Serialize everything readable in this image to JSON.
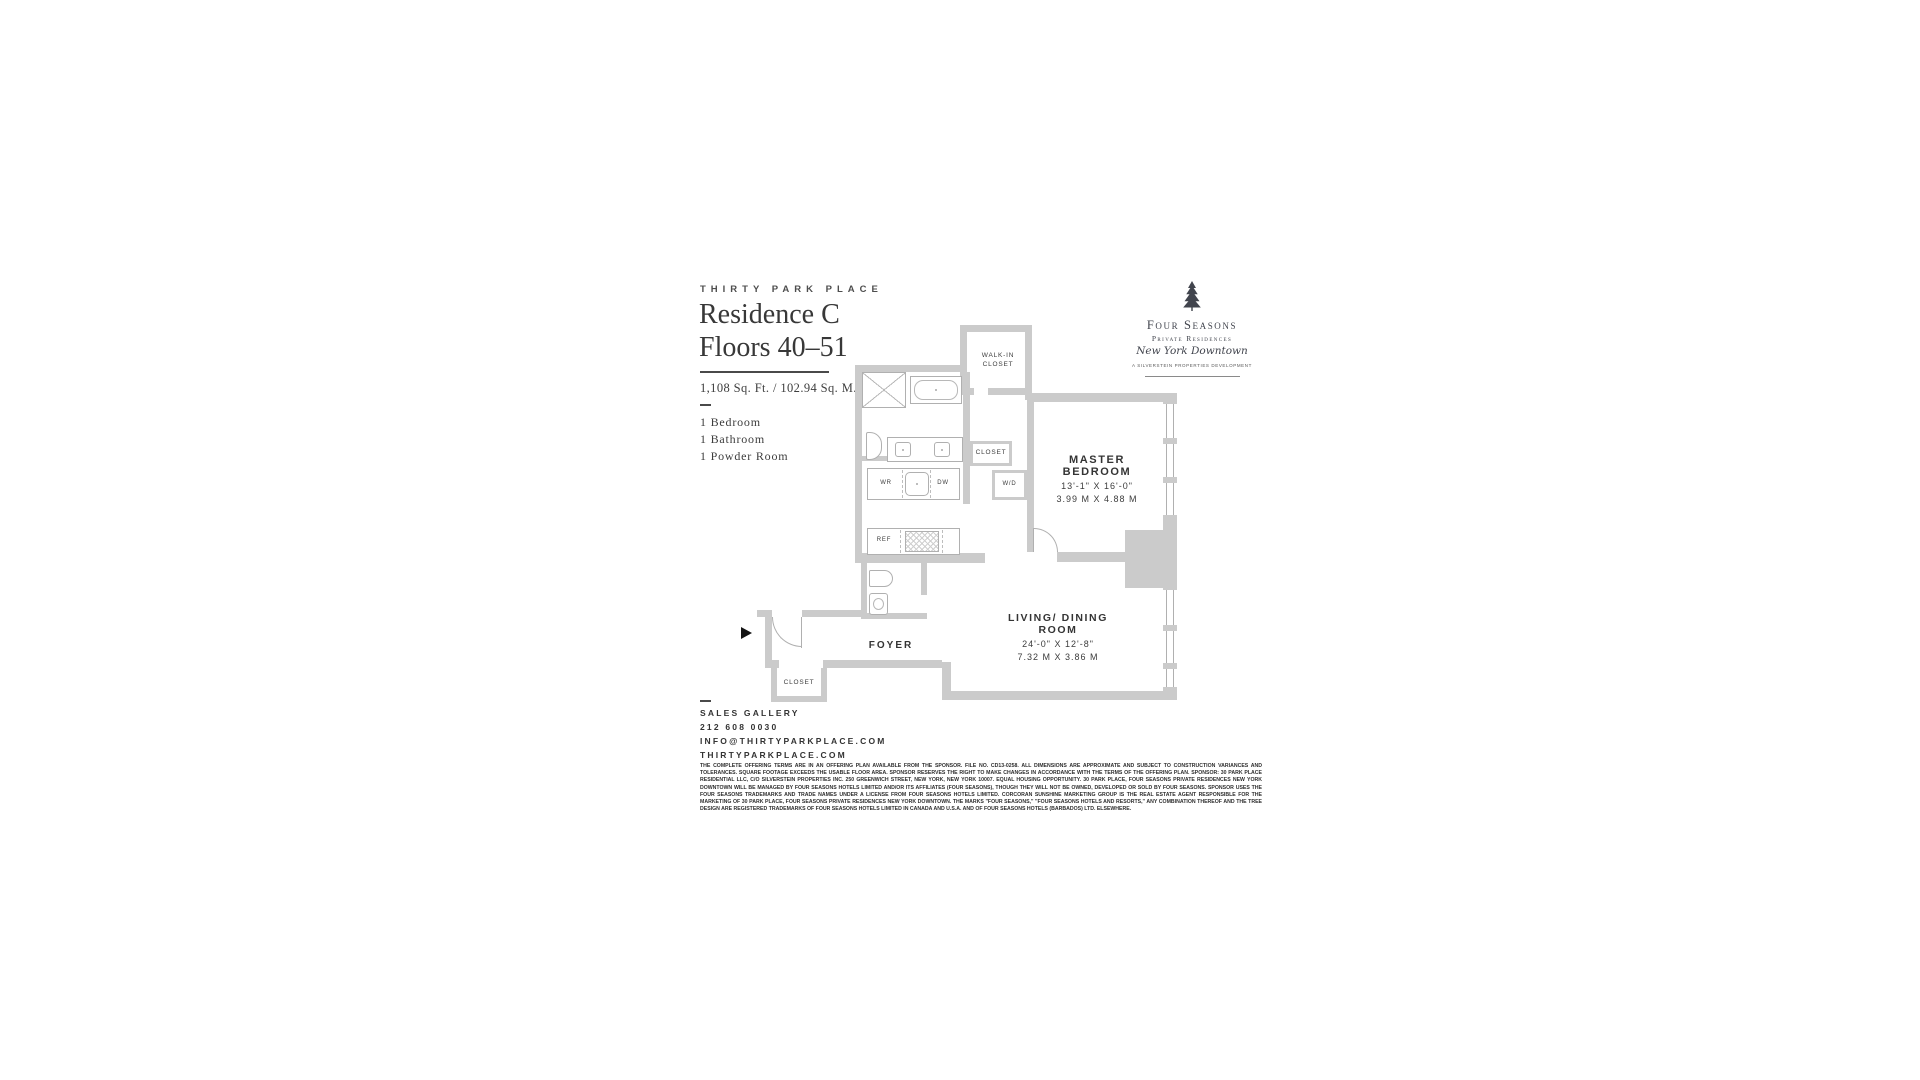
{
  "header": {
    "eyebrow": "THIRTY PARK PLACE",
    "title_line1": "Residence C",
    "title_line2": "Floors 40–51",
    "area": "1,108 Sq. Ft. / 102.94 Sq. M.",
    "features": [
      "1 Bedroom",
      "1 Bathroom",
      "1 Powder Room"
    ]
  },
  "logo": {
    "name": "Four Seasons",
    "subtitle": "Private Residences",
    "script": "New York Downtown",
    "tagline": "A SILVERSTEIN PROPERTIES DEVELOPMENT"
  },
  "plan": {
    "walk_in_closet": "WALK-IN CLOSET",
    "master_closet": "CLOSET",
    "washer_dryer": "W/D",
    "wine_ref": "WR",
    "dishwasher": "DW",
    "refrigerator": "REF",
    "master_bedroom": {
      "name": "MASTER BEDROOM",
      "imperial": "13'-1\" X 16'-0\"",
      "metric": "3.99 M X 4.88 M"
    },
    "living_dining": {
      "name": "LIVING/ DINING ROOM",
      "imperial": "24'-0\" X 12'-8\"",
      "metric": "7.32 M X 3.86 M"
    },
    "foyer": "FOYER",
    "foyer_closet": "CLOSET"
  },
  "contact": {
    "heading": "SALES GALLERY",
    "phone": "212 608 0030",
    "email": "INFO@THIRTYPARKPLACE.COM",
    "website": "THIRTYPARKPLACE.COM"
  },
  "legal": "THE COMPLETE OFFERING TERMS ARE IN AN OFFERING PLAN AVAILABLE FROM THE SPONSOR. FILE NO. CD13-0258. ALL DIMENSIONS ARE APPROXIMATE AND SUBJECT TO CONSTRUCTION VARIANCES AND TOLERANCES. SQUARE FOOTAGE EXCEEDS THE USABLE FLOOR AREA. SPONSOR RESERVES THE RIGHT TO MAKE CHANGES IN ACCORDANCE WITH THE TERMS OF THE OFFERING PLAN. SPONSOR: 30 PARK PLACE RESIDENTIAL LLC, C/O SILVERSTEIN PROPERTIES INC. 250 GREENWICH STREET, NEW YORK, NEW YORK 10007. EQUAL HOUSING OPPORTUNITY. 30 PARK PLACE, FOUR SEASONS PRIVATE RESIDENCES NEW YORK DOWNTOWN WILL BE MANAGED BY FOUR SEASONS HOTELS LIMITED AND/OR ITS AFFILIATES (FOUR SEASONS), THOUGH THEY WILL NOT BE OWNED, DEVELOPED OR SOLD BY FOUR SEASONS. SPONSOR USES THE FOUR SEASONS TRADEMARKS AND TRADE NAMES UNDER A LICENSE FROM FOUR SEASONS HOTELS LIMITED. CORCORAN SUNSHINE MARKETING GROUP IS THE REAL ESTATE AGENT RESPONSIBLE FOR THE MARKETING OF 30 PARK PLACE, FOUR SEASONS PRIVATE RESIDENCES NEW YORK DOWNTOWN. THE MARKS \"FOUR SEASONS,\" \"FOUR SEASONS HOTELS AND RESORTS,\" ANY COMBINATION THEREOF AND THE TREE DESIGN ARE REGISTERED TRADEMARKS OF FOUR SEASONS HOTELS LIMITED IN CANADA AND U.S.A. AND OF FOUR SEASONS HOTELS (BARBADOS) LTD. ELSEWHERE.",
  "colors": {
    "wall": "#cbcbcb",
    "fixture_line": "#b0b0b0",
    "text": "#3d3d3d",
    "logo": "#41444d"
  }
}
